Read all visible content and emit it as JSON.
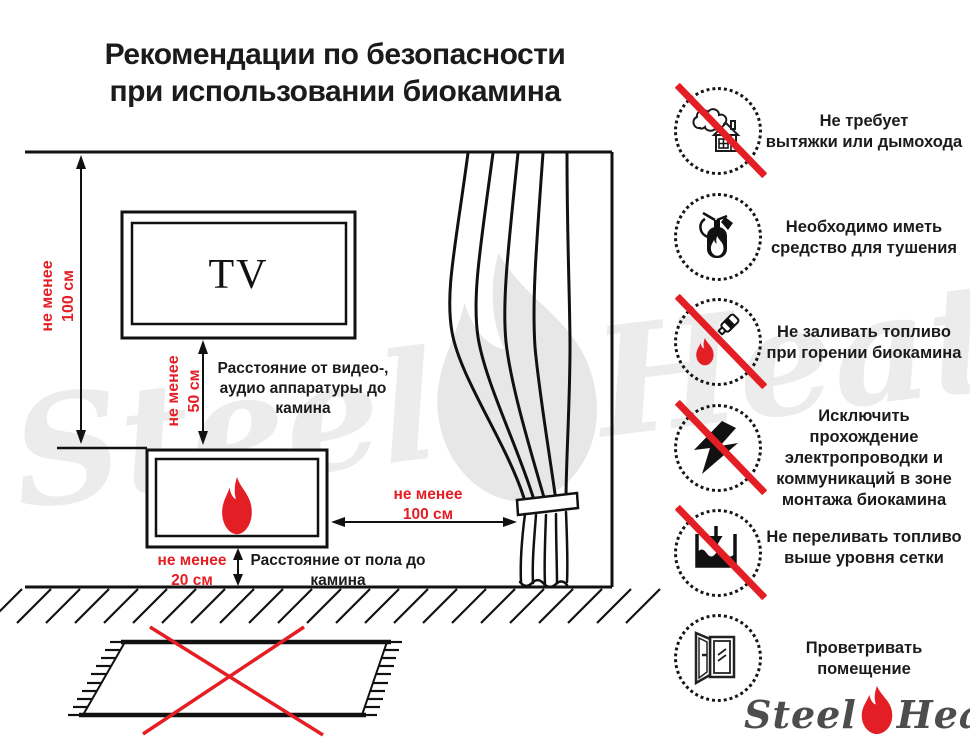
{
  "title": {
    "line1": "Рекомендации по безопасности",
    "line2": "при использовании биокамина"
  },
  "colors": {
    "accent_red": "#e31e24",
    "ink": "#1b1b1b",
    "watermark_gray": "#ececec",
    "logo_gray": "#4d4d4d"
  },
  "diagram": {
    "tv_label": "TV",
    "wall_dim": {
      "line1": "не менее",
      "line2": "100 см"
    },
    "tv_dim": {
      "line1": "не менее",
      "line2": "50 см"
    },
    "av_label": {
      "line1": "Расстояние от видео-,",
      "line2": "аудио аппаратуры до",
      "line3": "камина"
    },
    "curtain_dim": {
      "line1": "не менее",
      "line2": "100 см"
    },
    "floor_dim": {
      "line1": "не менее",
      "line2": "20 см"
    },
    "floor_label": {
      "line1": "Расстояние от пола до",
      "line2": "камина"
    }
  },
  "rules": [
    {
      "icon": "no-chimney-icon",
      "prohibited": true,
      "lines": [
        "Не требует",
        "вытяжки или дымохода"
      ]
    },
    {
      "icon": "extinguisher-icon",
      "prohibited": false,
      "lines": [
        "Необходимо иметь",
        "средство для тушения"
      ]
    },
    {
      "icon": "no-refuel-while-burning-icon",
      "prohibited": true,
      "lines": [
        "Не заливать топливо",
        "при горении биокамина"
      ]
    },
    {
      "icon": "no-electrical-wiring-icon",
      "prohibited": true,
      "lines": [
        "Исключить прохождение",
        "электропроводки и",
        "коммуникаций в зоне",
        "монтажа биокамина"
      ]
    },
    {
      "icon": "no-overfill-icon",
      "prohibited": true,
      "lines": [
        "Не переливать топливо",
        "выше уровня сетки"
      ]
    },
    {
      "icon": "ventilate-room-icon",
      "prohibited": false,
      "lines": [
        "Проветривать",
        "помещение"
      ]
    }
  ],
  "logo": {
    "steel": "Steel",
    "heat": "Heat"
  }
}
